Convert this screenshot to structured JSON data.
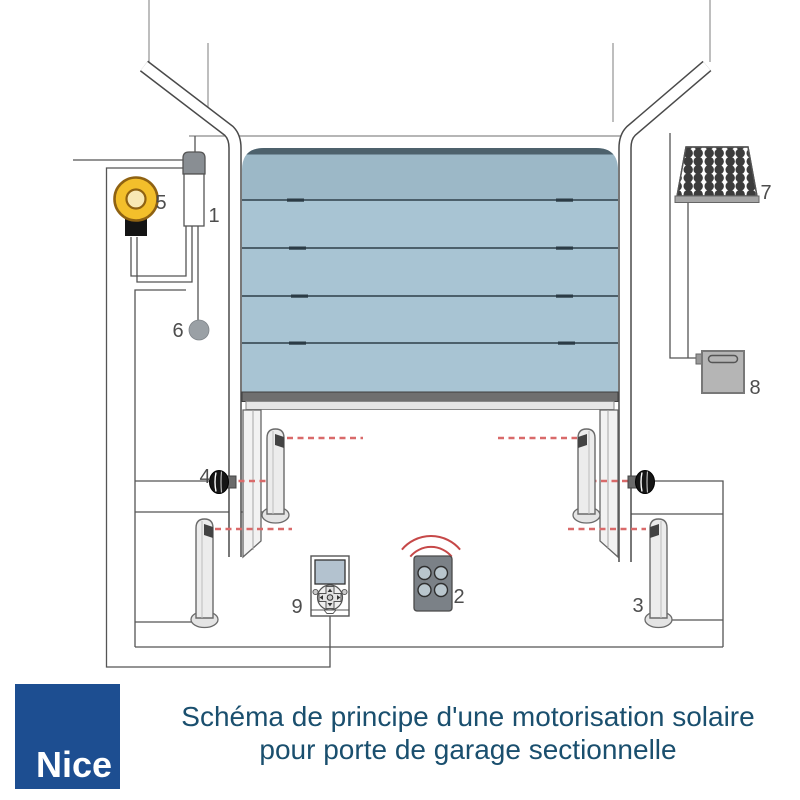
{
  "caption": {
    "line1": "Schéma de principe d'une motorisation solaire",
    "line2": "pour porte de garage sectionnelle",
    "color": "#1a4f6e"
  },
  "logo": {
    "text": "Nice",
    "bg_color": "#1d4e91",
    "text_color": "#ffffff"
  },
  "diagram": {
    "labels": {
      "motor_head": "1",
      "remote_control": "2",
      "photocell_column": "3",
      "wall_photocell": "4",
      "flashing_light": "5",
      "wall_button": "6",
      "solar_panel": "7",
      "battery_box": "8",
      "control_panel": "9"
    },
    "colors": {
      "door_panel": "#a8c4d3",
      "door_top_panel": "#9cb8c7",
      "door_top_strip": "#4d616c",
      "beam_red": "#d96a6a",
      "wave_red": "#c64848",
      "flasher_yellow": "#f3bf2b",
      "component_gray": "#b5b5b5",
      "solar_cell": "#3c3c3c",
      "line_gray": "#555555"
    }
  }
}
